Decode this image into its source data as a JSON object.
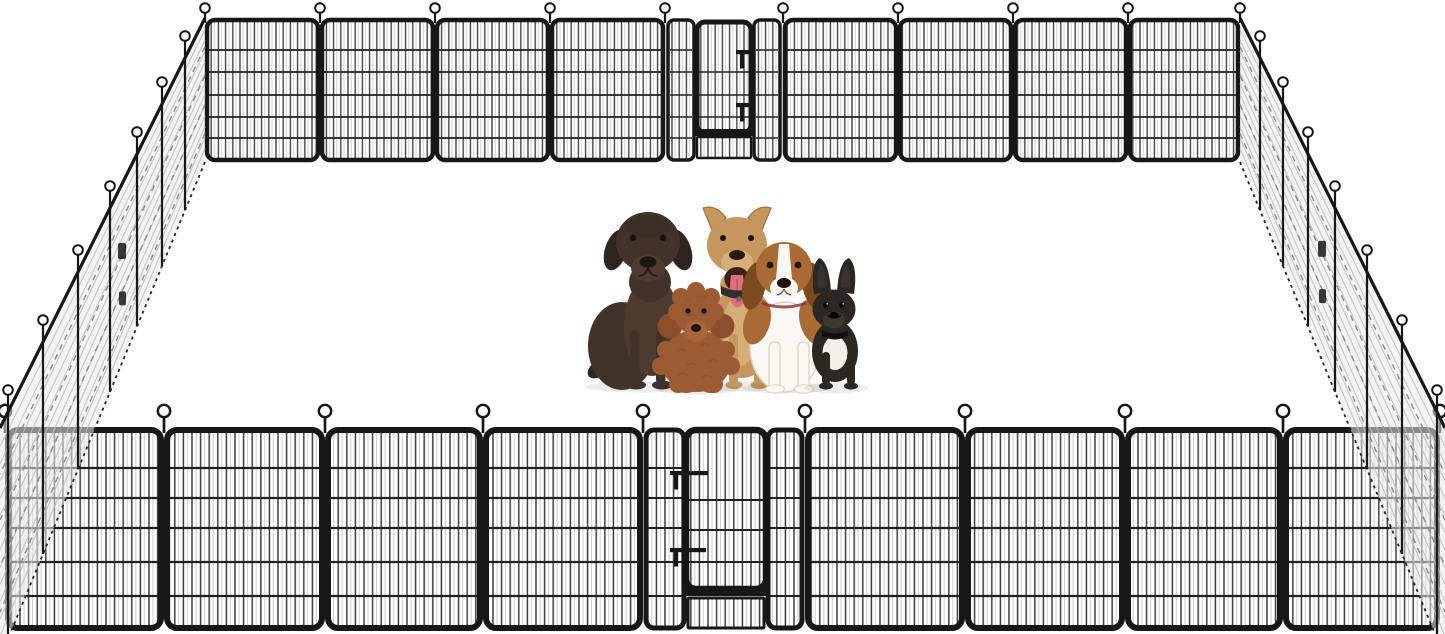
{
  "meta": {
    "domain": "product-image",
    "subject": "Heavy-duty outdoor metal dog playpen fence enclosure, rectangular layout with gates and loop ground stakes, five dogs sitting inside",
    "background_color": "#ffffff"
  },
  "playpen": {
    "frame_color": "#171717",
    "bar_color": "#3c3c3c",
    "bar_highlight": "#cccccc",
    "rail_color": "#202020",
    "side_mesh_fill": "#e9e9e9",
    "side_hatch_light": "#bdbdbd",
    "side_hatch_dark": "#8d8d8d",
    "stake_fill": "#ffffff",
    "back_fence": {
      "panel_count": 9,
      "gate_index": 4,
      "stake_count": 10
    },
    "front_fence": {
      "panel_count": 9,
      "gate_index": 4,
      "stake_count": 10
    },
    "left_fence": {
      "joint_count": 7,
      "has_gate": true
    },
    "right_fence": {
      "joint_count": 7,
      "has_gate": true
    },
    "gate_latch_count": 2
  },
  "dogs": [
    {
      "id": "chocolate-labrador",
      "label": "chocolate labrador",
      "base": "#42332a",
      "shade": "#30251e",
      "accent": "#4d3b2f",
      "nose": "#201611",
      "eye": "#1a100a"
    },
    {
      "id": "pit-bull",
      "label": "tan pit bull",
      "base": "#c5975f",
      "shade": "#a3753f",
      "accent": "#d7af7a",
      "mouth": "#3b2015",
      "tongue": "#de6f7e",
      "tongue_shade": "#bd5261",
      "collar": "#322d2a",
      "nose": "#2a1a10",
      "eye": "#1c1209"
    },
    {
      "id": "beagle",
      "label": "beagle",
      "base": "#a96a35",
      "shade": "#7c4a21",
      "accent": "#faf8f3",
      "accent_stroke": "#d9d1c4",
      "collar": "#8c3030",
      "nose": "#1a1109",
      "eye": "#23150a"
    },
    {
      "id": "french-bulldog",
      "label": "french bulldog",
      "base": "#2b2723",
      "shade": "#1c1916",
      "accent": "#f2eee8",
      "muzzle": "#3d3732",
      "collar": "#120f0c",
      "nose": "#070605",
      "eye": "#0b0907"
    },
    {
      "id": "toy-poodle",
      "label": "red toy poodle",
      "base": "#9d5b33",
      "shade": "#7e4726",
      "accent": "#b5703f",
      "ear": "#8c4f2c",
      "nose": "#1e120b",
      "eye": "#190f08"
    }
  ]
}
